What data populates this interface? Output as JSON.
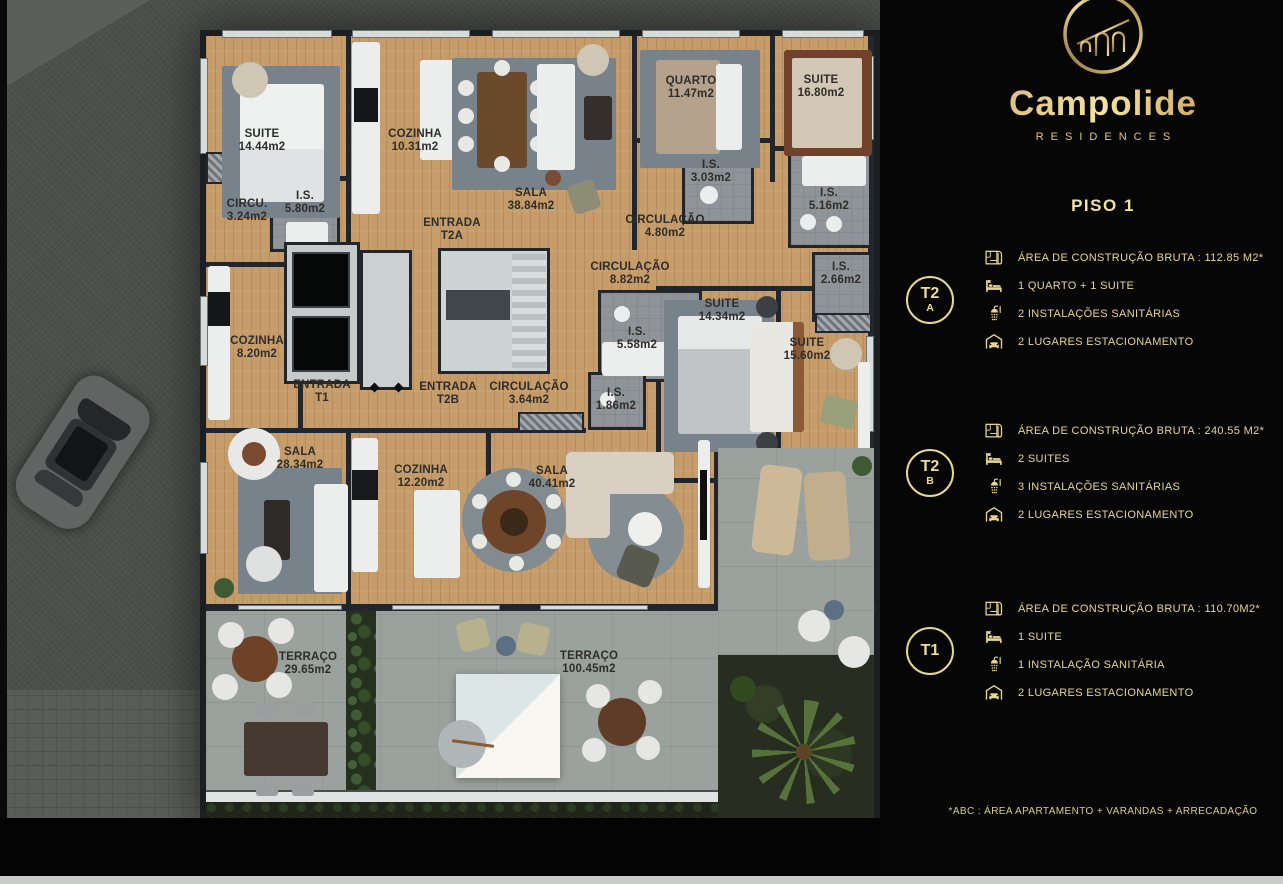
{
  "brand": {
    "name": "Campolide",
    "tagline": "RESIDENCES",
    "floor_title": "PISO 1",
    "footnote": "*ABC :  ÁREA APARTAMENTO + VARANDAS + ARRECADAÇÃO",
    "logo": "aqueduct-arches-in-gold-circle"
  },
  "colors": {
    "gold": "#e8d88e",
    "panel_black": "#060606",
    "wood_floor": "#c59c6a",
    "wall": "#24272b",
    "terrace": "#9ba19c",
    "street": "#4c4f4c"
  },
  "units": [
    {
      "badge_line1": "T2",
      "badge_line2": "A",
      "rows": [
        {
          "icon": "floorplan-icon",
          "text": "ÁREA DE CONSTRUÇÃO BRUTA :  112.85 M2*"
        },
        {
          "icon": "bed-icon",
          "text": "1 QUARTO + 1 SUITE"
        },
        {
          "icon": "shower-icon",
          "text": "2 INSTALAÇÕES SANITÁRIAS"
        },
        {
          "icon": "garage-icon",
          "text": "2 LUGARES ESTACIONAMENTO"
        }
      ]
    },
    {
      "badge_line1": "T2",
      "badge_line2": "B",
      "rows": [
        {
          "icon": "floorplan-icon",
          "text": "ÁREA DE CONSTRUÇÃO BRUTA :  240.55 M2*"
        },
        {
          "icon": "bed-icon",
          "text": "2 SUITES"
        },
        {
          "icon": "shower-icon",
          "text": "3 INSTALAÇÕES SANITÁRIAS"
        },
        {
          "icon": "garage-icon",
          "text": "2 LUGARES ESTACIONAMENTO"
        }
      ]
    },
    {
      "badge_line1": "T1",
      "badge_line2": "",
      "rows": [
        {
          "icon": "floorplan-icon",
          "text": "ÁREA DE CONSTRUÇÃO BRUTA :  110.70M2*"
        },
        {
          "icon": "bed-icon",
          "text": "1 SUITE"
        },
        {
          "icon": "shower-icon",
          "text": "1 INSTALAÇÃO SANITÁRIA"
        },
        {
          "icon": "garage-icon",
          "text": "2 LUGARES ESTACIONAMENTO"
        }
      ]
    }
  ],
  "floorplan": {
    "rooms": [
      {
        "label": "SUITE",
        "area": "14.44m2",
        "x": 262,
        "y": 141
      },
      {
        "label": "COZINHA",
        "area": "10.31m2",
        "x": 415,
        "y": 141
      },
      {
        "label": "SALA",
        "area": "38.84m2",
        "x": 531,
        "y": 200
      },
      {
        "label": "ENTRADA",
        "area": "T2A",
        "x": 452,
        "y": 230
      },
      {
        "label": "I.S.",
        "area": "5.80m2",
        "x": 305,
        "y": 203
      },
      {
        "label": "CIRCU.",
        "area": "3.24m2",
        "x": 247,
        "y": 211
      },
      {
        "label": "QUARTO",
        "area": "11.47m2",
        "x": 691,
        "y": 88
      },
      {
        "label": "SUITE",
        "area": "16.80m2",
        "x": 821,
        "y": 87
      },
      {
        "label": "I.S.",
        "area": "3.03m2",
        "x": 711,
        "y": 172
      },
      {
        "label": "CIRCULAÇÃO",
        "area": "4.80m2",
        "x": 665,
        "y": 227
      },
      {
        "label": "I.S.",
        "area": "5.16m2",
        "x": 829,
        "y": 200
      },
      {
        "label": "CIRCULAÇÃO",
        "area": "8.82m2",
        "x": 630,
        "y": 274
      },
      {
        "label": "I.S.",
        "area": "2.66m2",
        "x": 841,
        "y": 274
      },
      {
        "label": "COZINHA",
        "area": "8.20m2",
        "x": 257,
        "y": 348
      },
      {
        "label": "I.S.",
        "area": "5.58m2",
        "x": 637,
        "y": 339
      },
      {
        "label": "SUITE",
        "area": "14.34m2",
        "x": 722,
        "y": 311
      },
      {
        "label": "SUITE",
        "area": "15.60m2",
        "x": 807,
        "y": 350
      },
      {
        "label": "ENTRADA",
        "area": "T1",
        "x": 322,
        "y": 392
      },
      {
        "label": "ENTRADA",
        "area": "T2B",
        "x": 448,
        "y": 394
      },
      {
        "label": "CIRCULAÇÃO",
        "area": "3.64m2",
        "x": 529,
        "y": 394
      },
      {
        "label": "I.S.",
        "area": "1.86m2",
        "x": 616,
        "y": 400
      },
      {
        "label": "SALA",
        "area": "28.34m2",
        "x": 300,
        "y": 459
      },
      {
        "label": "COZINHA",
        "area": "12.20m2",
        "x": 421,
        "y": 477
      },
      {
        "label": "SALA",
        "area": "40.41m2",
        "x": 552,
        "y": 478
      },
      {
        "label": "TERRAÇO",
        "area": "29.65m2",
        "x": 308,
        "y": 664
      },
      {
        "label": "TERRAÇO",
        "area": "100.45m2",
        "x": 589,
        "y": 663
      }
    ]
  }
}
